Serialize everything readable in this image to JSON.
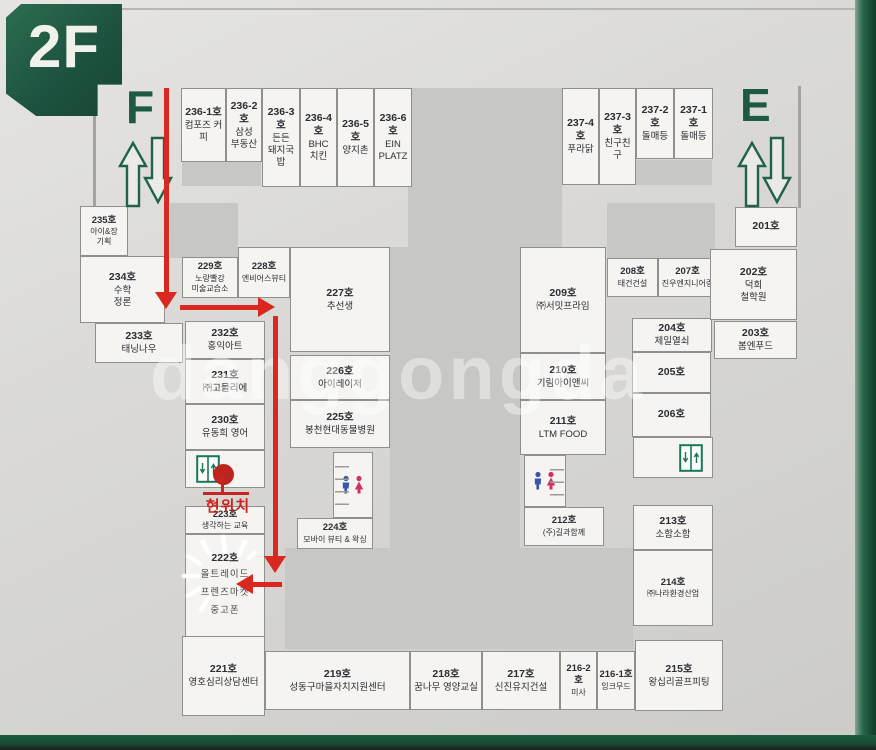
{
  "floor_badge": "2F",
  "stairs": {
    "f": "F",
    "e": "E"
  },
  "current_location": {
    "label": "현위치"
  },
  "watermark": "danggongda",
  "colors": {
    "frame_green": "#1d5c41",
    "badge_green": "#1d5340",
    "path_red": "#d8281f",
    "dot_red": "#bd231f",
    "board_gray": "#d8d7d4",
    "cell_white": "#f5f4f1"
  },
  "icons": {
    "elevator": "elevator-icon",
    "restroom": "restroom-icon",
    "stairs_up_down": "up-down-arrows-icon",
    "current_dot": "current-location-dot"
  },
  "units": {
    "u236_1": {
      "no": "236-1호",
      "name": "컴포즈 커피"
    },
    "u236_2": {
      "no": "236-2호",
      "name": "삼성\n부동산"
    },
    "u236_3": {
      "no": "236-3호",
      "name": "든든\n돼지국밥"
    },
    "u236_4": {
      "no": "236-4호",
      "name": "BHC\n치킨"
    },
    "u236_5": {
      "no": "236-5호",
      "name": "양지촌"
    },
    "u236_6": {
      "no": "236-6호",
      "name": "EIN\nPLATZ"
    },
    "u237_4": {
      "no": "237-4호",
      "name": "푸라닭"
    },
    "u237_3": {
      "no": "237-3호",
      "name": "친구친구"
    },
    "u237_2": {
      "no": "237-2호",
      "name": "돌매등"
    },
    "u237_1": {
      "no": "237-1호",
      "name": "돌매등"
    },
    "u235": {
      "no": "235호",
      "name": "아이&장\n기획"
    },
    "u234": {
      "no": "234호",
      "name": "수학\n정론"
    },
    "u233": {
      "no": "233호",
      "name": "태닝나우"
    },
    "u232": {
      "no": "232호",
      "name": "홍익아트"
    },
    "u231": {
      "no": "231호",
      "name": "㈜고믈리에"
    },
    "u230": {
      "no": "230호",
      "name": "유동희 영어"
    },
    "u229": {
      "no": "229호",
      "name": "노랑빨강\n미술교습소"
    },
    "u228": {
      "no": "228호",
      "name": "엔비어스뷰티"
    },
    "u227": {
      "no": "227호",
      "name": "추선생"
    },
    "u226": {
      "no": "226호",
      "name": "아이레이저"
    },
    "u225": {
      "no": "225호",
      "name": "봉천현대동물병원"
    },
    "u224": {
      "no": "224호",
      "name": "모바이 뷰티 & 왁싱"
    },
    "u223": {
      "no": "223호",
      "name": "생각하는 교육"
    },
    "u222": {
      "no": "222호",
      "name": "올트레이드\n프렌즈마켓\n중고폰"
    },
    "u221": {
      "no": "221호",
      "name": "영호심리상담센터"
    },
    "u219": {
      "no": "219호",
      "name": "성동구마을자치지원센터"
    },
    "u218": {
      "no": "218호",
      "name": "꿈나무 영양교실"
    },
    "u217": {
      "no": "217호",
      "name": "신진유지건설"
    },
    "u216_2": {
      "no": "216-2호",
      "name": "미사"
    },
    "u216_1": {
      "no": "216-1호",
      "name": "잉크무드"
    },
    "u215": {
      "no": "215호",
      "name": "왕십리골프피팅"
    },
    "u214": {
      "no": "214호",
      "name": "㈜나라환경산업"
    },
    "u213": {
      "no": "213호",
      "name": "소함소함"
    },
    "u212": {
      "no": "212호",
      "name": "(주)길과함께"
    },
    "u211": {
      "no": "211호",
      "name": "LTM FOOD"
    },
    "u210": {
      "no": "210호",
      "name": "기림아이앤씨"
    },
    "u209": {
      "no": "209호",
      "name": "㈜서밋프라임"
    },
    "u208": {
      "no": "208호",
      "name": "태건건설"
    },
    "u207": {
      "no": "207호",
      "name": "진우엔지니어링"
    },
    "u206": {
      "no": "206호",
      "name": ""
    },
    "u205": {
      "no": "205호",
      "name": ""
    },
    "u204": {
      "no": "204호",
      "name": "제일열쇠"
    },
    "u203": {
      "no": "203호",
      "name": "봄엔푸드"
    },
    "u202": {
      "no": "202호",
      "name": "덕희\n철학원"
    },
    "u201": {
      "no": "201호",
      "name": ""
    }
  }
}
